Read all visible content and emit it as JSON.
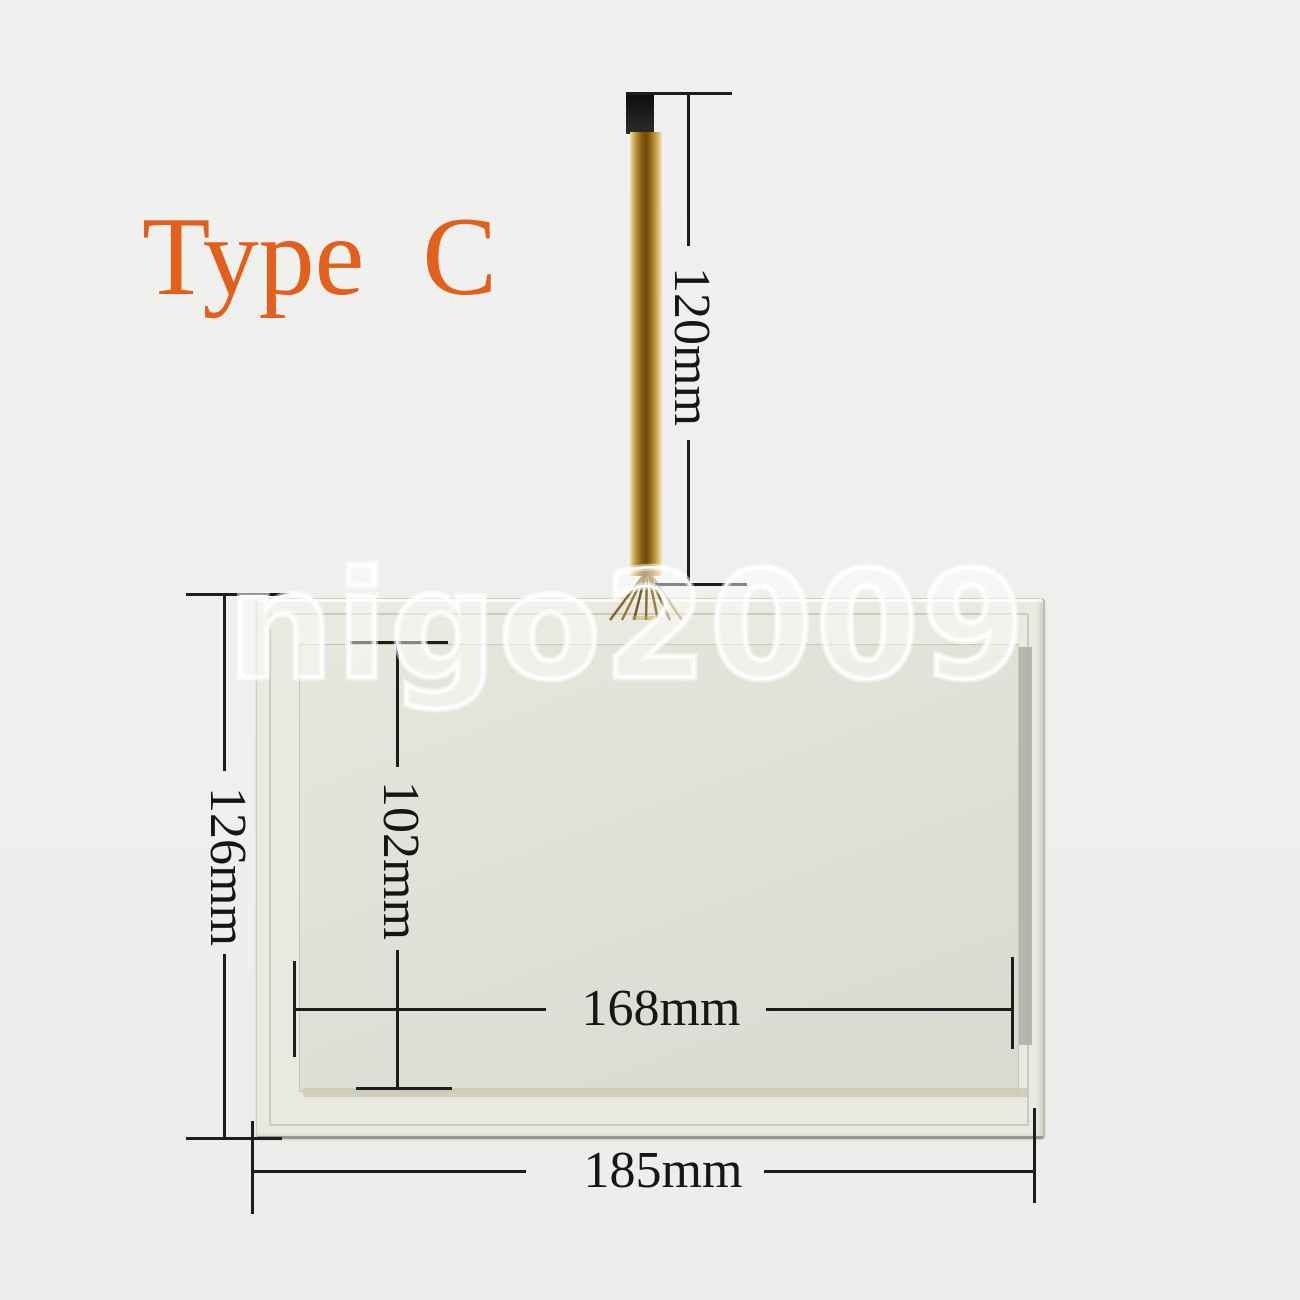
{
  "image": {
    "type_label": {
      "prefix": "Type",
      "variant": "C"
    },
    "watermark": "nigo2009",
    "dimensions": {
      "cable_length": "120mm",
      "panel_height": "126mm",
      "active_area_height": "102mm",
      "active_area_width": "168mm",
      "panel_width": "185mm"
    },
    "colors": {
      "type_label_orange": "#e2601c",
      "dimension_line": "#1d1d1d",
      "cable_gold": "#b8872c",
      "connector_black": "#141414",
      "panel_frame": "#eae9e1",
      "panel_active_area": "#dedfd6",
      "background": "#eff0ee",
      "watermark": "#ffffff"
    }
  }
}
